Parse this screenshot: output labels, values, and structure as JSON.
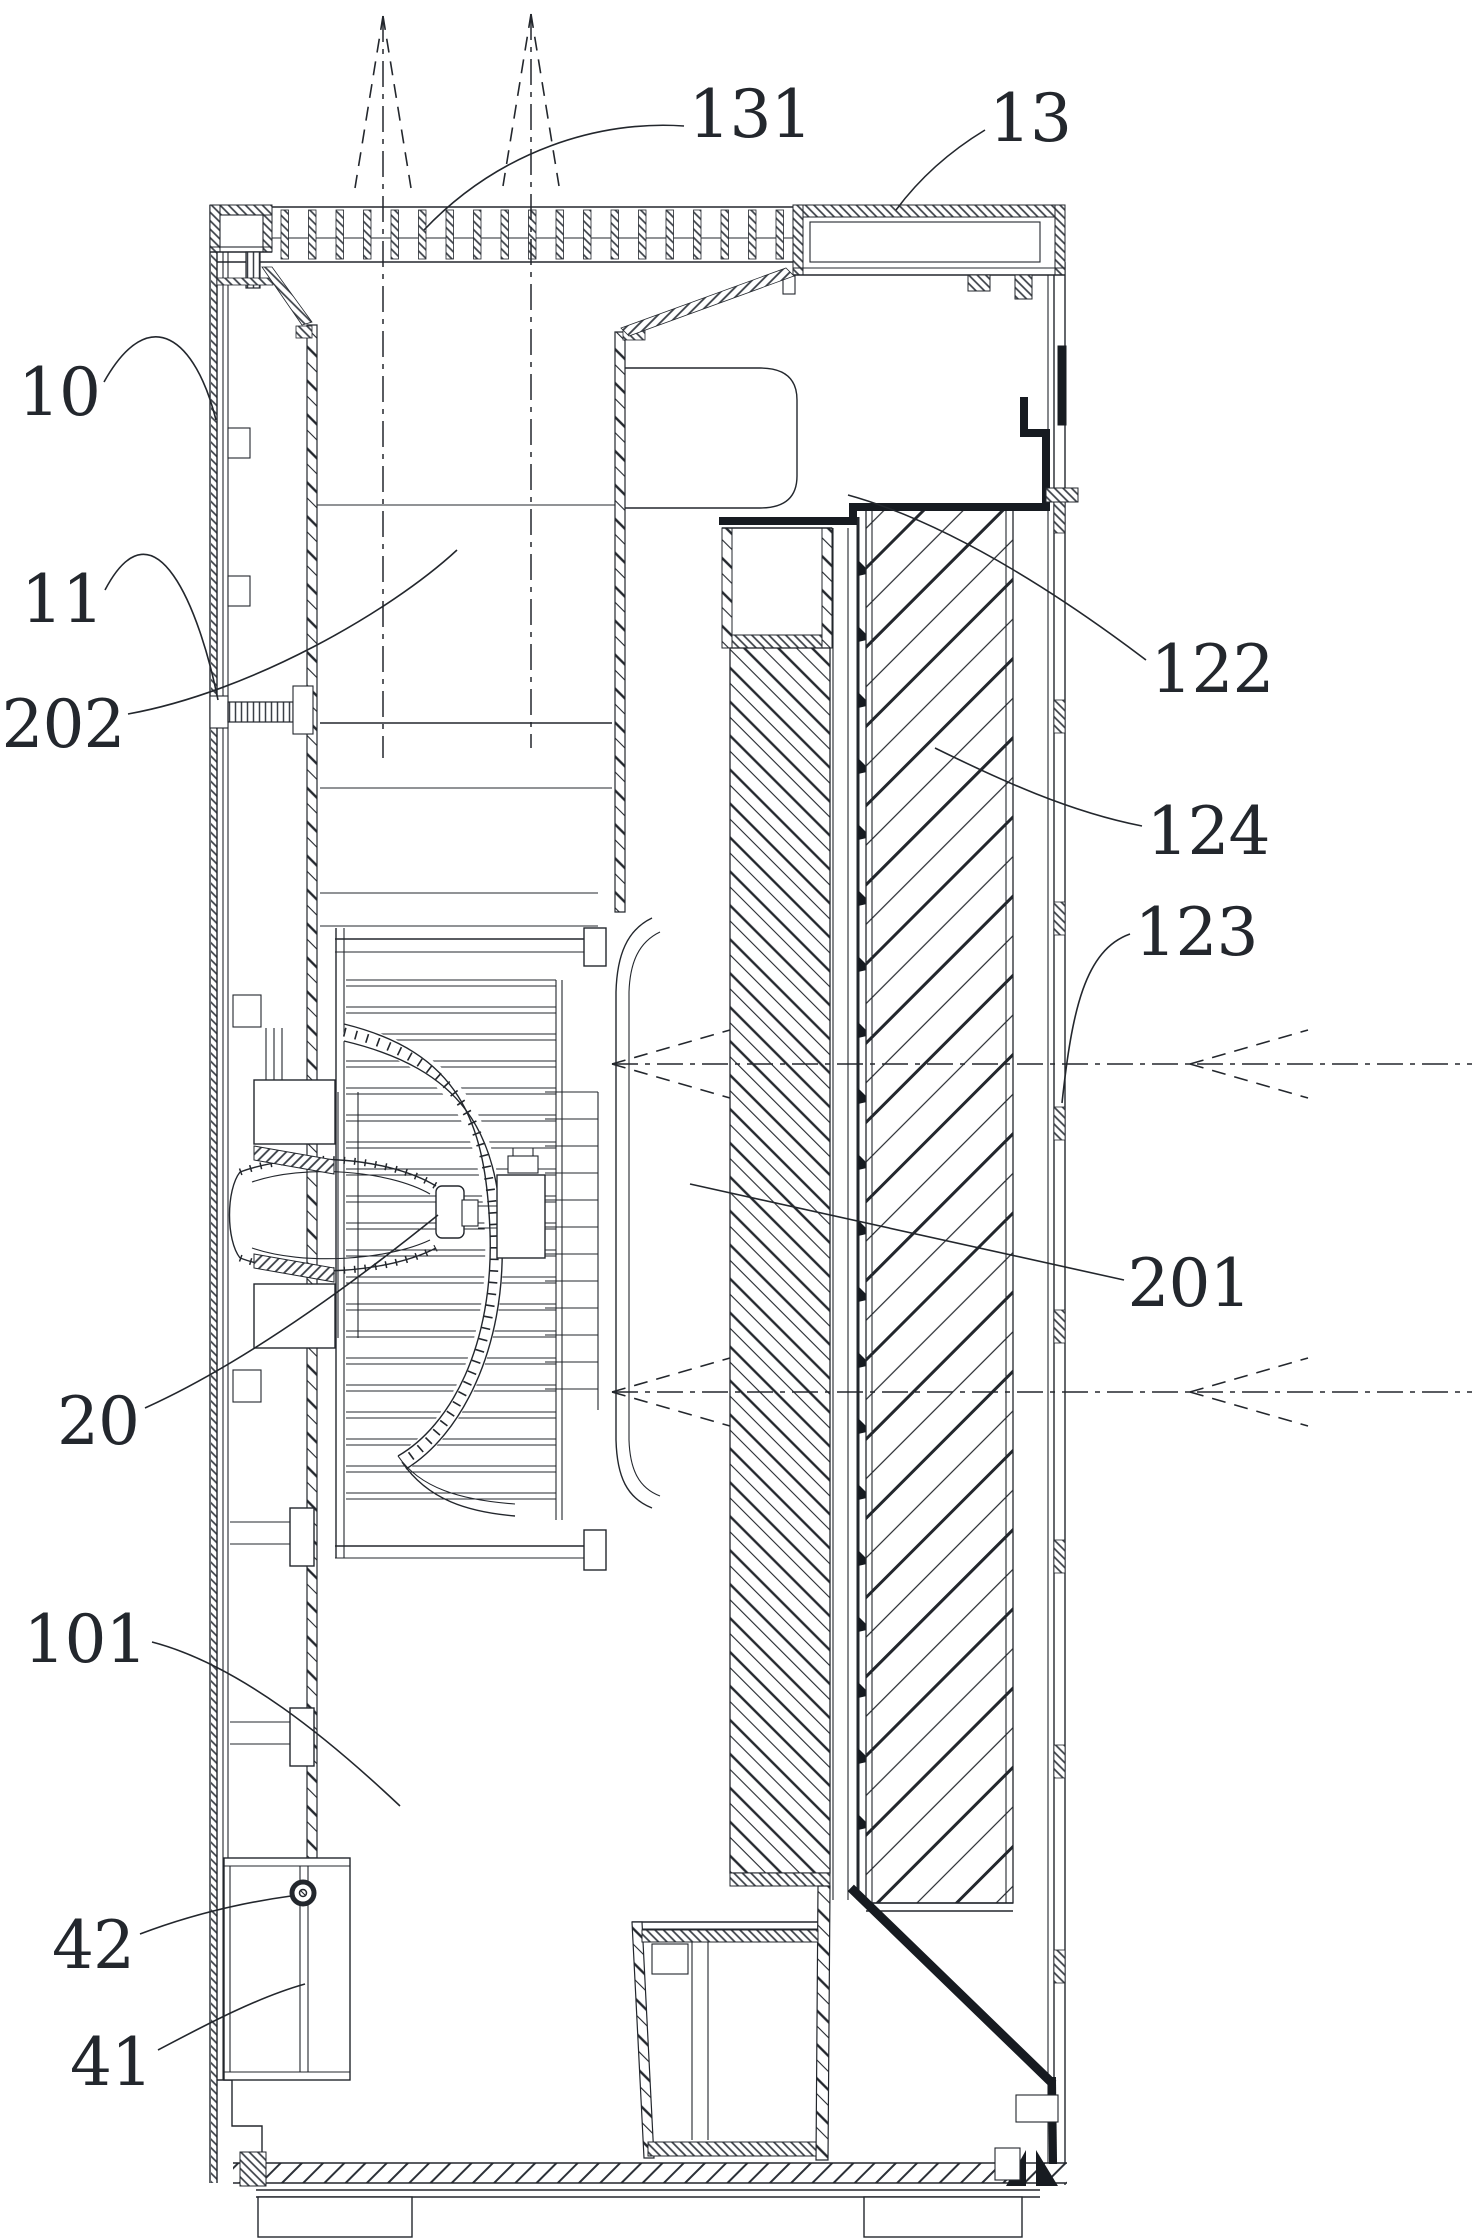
{
  "figure": {
    "background": "#ffffff",
    "ink": "#23272d",
    "bold_ink": "#171b21",
    "type": "patent-cross-section-line-drawing"
  },
  "callouts": [
    {
      "id": "131",
      "text": "131",
      "x": 750,
      "y": 113,
      "leader": "M684,126 C600,120 500,150 424,230"
    },
    {
      "id": "13",
      "text": "13",
      "x": 1030,
      "y": 117,
      "leader": "M985,130 C952,150 922,175 896,210"
    },
    {
      "id": "10",
      "text": "10",
      "x": 59,
      "y": 391,
      "leader": "M104,382 C150,300 196,340 216,420"
    },
    {
      "id": "11",
      "text": "11",
      "x": 62,
      "y": 598,
      "leader": "M105,590 C155,495 200,610 218,700"
    },
    {
      "id": "202",
      "text": "202",
      "x": 63,
      "y": 723,
      "leader": "M128,714 C250,692 390,612 457,550"
    },
    {
      "id": "122",
      "text": "122",
      "x": 1212,
      "y": 668,
      "leader": "M1146,660 C1080,610 960,526 848,495"
    },
    {
      "id": "124",
      "text": "124",
      "x": 1208,
      "y": 830,
      "leader": "M1142,826 C1070,812 1000,780 935,748"
    },
    {
      "id": "123",
      "text": "123",
      "x": 1196,
      "y": 931,
      "leader": "M1130,934 C1085,950 1072,1010 1062,1103"
    },
    {
      "id": "201",
      "text": "201",
      "x": 1189,
      "y": 1282,
      "leader": "M1124,1280 L690,1184"
    },
    {
      "id": "20",
      "text": "20",
      "x": 98,
      "y": 1420,
      "leader": "M145,1408 C240,1365 345,1290 438,1215"
    },
    {
      "id": "101",
      "text": "101",
      "x": 85,
      "y": 1638,
      "leader": "M152,1642 C240,1665 330,1740 400,1806"
    },
    {
      "id": "42",
      "text": "42",
      "x": 93,
      "y": 1944,
      "leader": "M140,1934 C190,1915 240,1903 291,1896"
    },
    {
      "id": "41",
      "text": "41",
      "x": 111,
      "y": 2061,
      "leader": "M158,2050 C200,2028 255,1998 305,1984"
    }
  ],
  "outlet_arrows": [
    {
      "x": 383,
      "tip_y": 16,
      "shaft_end_y": 758,
      "arm_dx": 28,
      "arm_dy": 172
    },
    {
      "x": 531,
      "tip_y": 14,
      "shaft_end_y": 748,
      "arm_dx": 28,
      "arm_dy": 172
    }
  ],
  "inlet_arrows": [
    {
      "y": 1064,
      "inner_tip_x": 612,
      "outer_tip_x": 1190,
      "end_x": 1472,
      "arm_dx": 118,
      "arm_dy": 34
    },
    {
      "y": 1392,
      "inner_tip_x": 612,
      "outer_tip_x": 1190,
      "end_x": 1472,
      "arm_dx": 118,
      "arm_dy": 34
    }
  ]
}
